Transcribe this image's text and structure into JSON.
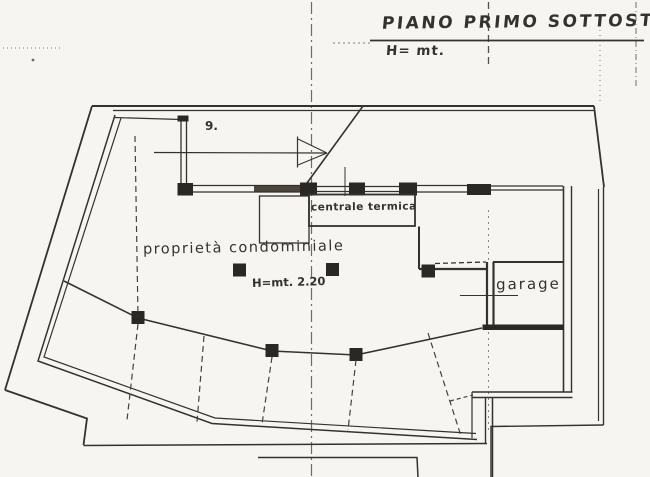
{
  "page": {
    "background": "#f6f5f1",
    "ink": "#35322b"
  },
  "titles": {
    "main": "PIANO PRIMO SOTTOSTRADA",
    "scale_note": "H= mt."
  },
  "plan_labels": {
    "room_number": "9.",
    "boiler_room": "centrale termica",
    "common_area": "proprietà condominiale",
    "height_note": "H=mt. 2.20",
    "garage": "garage"
  }
}
